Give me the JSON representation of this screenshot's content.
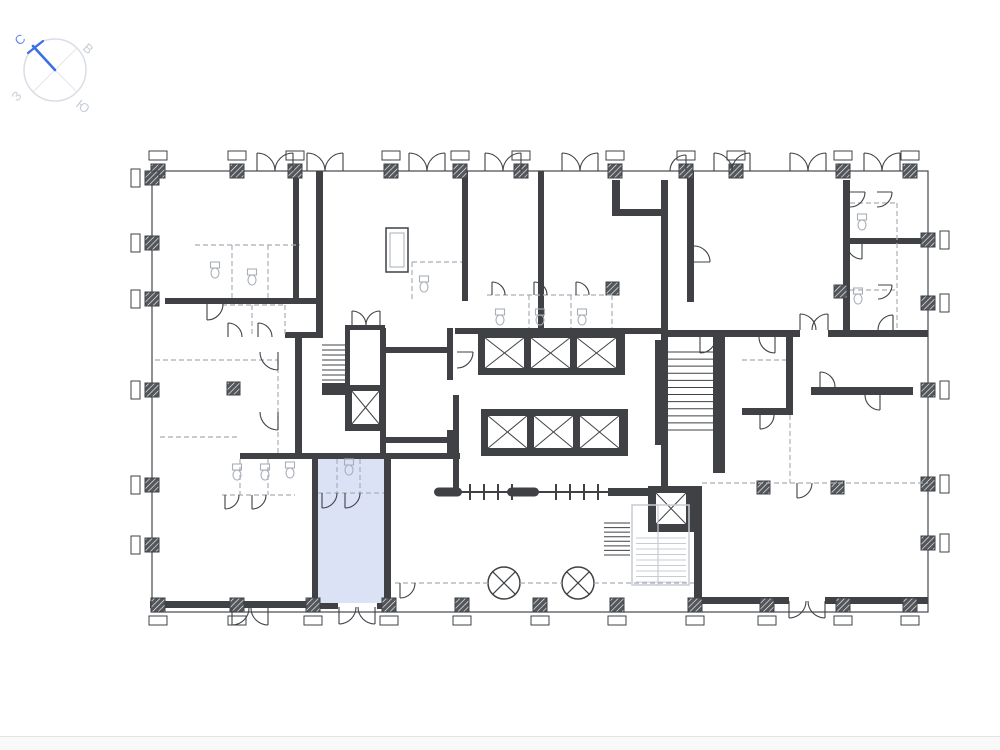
{
  "page": {
    "background": "#ffffff",
    "footer_line_color": "#e3e3e6",
    "footer_band_color": "#f9f9fa"
  },
  "compass": {
    "labels": {
      "north": "С",
      "east": "В",
      "west": "З",
      "south": "Ю"
    },
    "colors": {
      "needle": "#3a6fe8",
      "north_label": "#6188ec",
      "other_labels": "#c8cdd7",
      "ring": "#d9dee6",
      "cross": "#e4e7ec"
    }
  },
  "plan": {
    "colors": {
      "wall": "#3f4145",
      "line": "#46484c",
      "light": "#a9afb8",
      "stair": "#c7ccd4",
      "highlight": "#dbe2f6",
      "white": "#ffffff"
    },
    "highlight_room": {
      "x": 318,
      "y": 459,
      "w": 66,
      "h": 144
    },
    "primitives": [
      [
        "r",
        318,
        459,
        66,
        144,
        "highlight"
      ],
      [
        "ro",
        152,
        171,
        776,
        441,
        "line",
        1.2
      ],
      [
        "r",
        293,
        171,
        6,
        130,
        "wall"
      ],
      [
        "r",
        316,
        171,
        7,
        163,
        "wall"
      ],
      [
        "r",
        165,
        298,
        157,
        6,
        "wall"
      ],
      [
        "r",
        295,
        334,
        7,
        123,
        "wall"
      ],
      [
        "r",
        285,
        332,
        38,
        6,
        "wall"
      ],
      [
        "r",
        240,
        453,
        220,
        6,
        "wall"
      ],
      [
        "r",
        312,
        459,
        6,
        148,
        "wall"
      ],
      [
        "r",
        384,
        453,
        7,
        154,
        "wall"
      ],
      [
        "r",
        150,
        601,
        163,
        7,
        "wall"
      ],
      [
        "r",
        313,
        603,
        25,
        6,
        "wall"
      ],
      [
        "r",
        377,
        603,
        14,
        6,
        "wall"
      ],
      [
        "r",
        462,
        171,
        6,
        130,
        "wall"
      ],
      [
        "r",
        538,
        171,
        6,
        160,
        "wall"
      ],
      [
        "r",
        612,
        180,
        8,
        36,
        "wall"
      ],
      [
        "r",
        612,
        209,
        56,
        7,
        "wall"
      ],
      [
        "r",
        661,
        180,
        7,
        310,
        "wall"
      ],
      [
        "r",
        455,
        328,
        208,
        6,
        "wall"
      ],
      [
        "r",
        687,
        171,
        7,
        131,
        "wall"
      ],
      [
        "r",
        843,
        180,
        7,
        156,
        "wall"
      ],
      [
        "r",
        850,
        238,
        78,
        6,
        "wall"
      ],
      [
        "r",
        663,
        330,
        137,
        7,
        "wall"
      ],
      [
        "r",
        828,
        330,
        100,
        7,
        "wall"
      ],
      [
        "r",
        786,
        337,
        7,
        78,
        "wall"
      ],
      [
        "r",
        742,
        408,
        51,
        7,
        "wall"
      ],
      [
        "r",
        811,
        387,
        102,
        8,
        "wall"
      ],
      [
        "r",
        380,
        328,
        6,
        129,
        "wall"
      ],
      [
        "r",
        386,
        347,
        66,
        6,
        "wall"
      ],
      [
        "r",
        447,
        328,
        6,
        52,
        "wall"
      ],
      [
        "r",
        447,
        430,
        6,
        27,
        "wall"
      ],
      [
        "r",
        386,
        437,
        61,
        6,
        "wall"
      ],
      [
        "r",
        453,
        395,
        6,
        100,
        "wall"
      ],
      [
        "r",
        608,
        488,
        45,
        8,
        "wall"
      ],
      [
        "r",
        694,
        486,
        8,
        116,
        "wall"
      ],
      [
        "r",
        655,
        340,
        6,
        105,
        "wall"
      ],
      [
        "r",
        713,
        337,
        12,
        136,
        "wall"
      ],
      [
        "r",
        695,
        597,
        94,
        7,
        "wall"
      ],
      [
        "r",
        825,
        597,
        103,
        7,
        "wall"
      ],
      [
        "r",
        322,
        383,
        24,
        12,
        "wall"
      ],
      [
        "r",
        478,
        331,
        147,
        44,
        "wall"
      ],
      [
        "e",
        484,
        337,
        41,
        32
      ],
      [
        "e",
        530,
        337,
        41,
        32
      ],
      [
        "e",
        576,
        337,
        41,
        32
      ],
      [
        "r",
        481,
        409,
        147,
        47,
        "wall"
      ],
      [
        "e",
        487,
        415,
        41,
        34
      ],
      [
        "e",
        533,
        415,
        41,
        34
      ],
      [
        "e",
        579,
        415,
        41,
        34
      ],
      [
        "r",
        345,
        325,
        40,
        106,
        "wall"
      ],
      [
        "r",
        350,
        330,
        30,
        55,
        "white"
      ],
      [
        "e",
        351,
        390,
        29,
        35
      ],
      [
        "r",
        648,
        486,
        46,
        46,
        "wall"
      ],
      [
        "e",
        655,
        492,
        32,
        33
      ],
      [
        "ro",
        386,
        228,
        22,
        44,
        "wall",
        1.5
      ],
      [
        "ro",
        390,
        233,
        14,
        34,
        "light",
        1
      ],
      [
        "st",
        322,
        345,
        25,
        40,
        8,
        "wall"
      ],
      [
        "st",
        668,
        352,
        45,
        78,
        11,
        "wall"
      ],
      [
        "st",
        604,
        523,
        26,
        32,
        7,
        "wall"
      ],
      [
        "ro",
        632,
        505,
        57,
        80,
        "stair",
        1.5
      ],
      [
        "st",
        636,
        538,
        50,
        44,
        8,
        "stair"
      ],
      [
        "l",
        658,
        505,
        658,
        585,
        "stair",
        1.2
      ],
      [
        "cx",
        504,
        583,
        16
      ],
      [
        "cx",
        578,
        583,
        16
      ],
      [
        "l",
        457,
        492,
        648,
        492,
        "wall",
        2
      ],
      [
        "l",
        470,
        484,
        470,
        500,
        "wall",
        2
      ],
      [
        "l",
        484,
        484,
        484,
        500,
        "wall",
        2
      ],
      [
        "l",
        498,
        484,
        498,
        500,
        "wall",
        2
      ],
      [
        "l",
        512,
        484,
        512,
        500,
        "wall",
        2
      ],
      [
        "l",
        556,
        484,
        556,
        500,
        "wall",
        2
      ],
      [
        "l",
        570,
        484,
        570,
        500,
        "wall",
        2
      ],
      [
        "l",
        584,
        484,
        584,
        500,
        "wall",
        2
      ],
      [
        "l",
        598,
        484,
        598,
        500,
        "wall",
        2
      ],
      [
        "p",
        448,
        492,
        28,
        9
      ],
      [
        "p",
        523,
        492,
        32,
        9
      ],
      [
        "col",
        158,
        171,
        "t"
      ],
      [
        "col",
        237,
        171,
        "t"
      ],
      [
        "col",
        295,
        171,
        "t"
      ],
      [
        "col",
        391,
        171,
        "t"
      ],
      [
        "col",
        460,
        171,
        "t"
      ],
      [
        "col",
        521,
        171,
        "t"
      ],
      [
        "col",
        615,
        171,
        "t"
      ],
      [
        "col",
        686,
        171,
        "t"
      ],
      [
        "col",
        736,
        171,
        "t"
      ],
      [
        "col",
        843,
        171,
        "t"
      ],
      [
        "col",
        910,
        171,
        "t"
      ],
      [
        "col",
        152,
        178,
        "l"
      ],
      [
        "col",
        152,
        243,
        "l"
      ],
      [
        "col",
        152,
        299,
        "l"
      ],
      [
        "col",
        152,
        390,
        "l"
      ],
      [
        "col",
        152,
        485,
        "l"
      ],
      [
        "col",
        152,
        545,
        "l"
      ],
      [
        "col",
        928,
        240,
        "r"
      ],
      [
        "col",
        928,
        303,
        "r"
      ],
      [
        "col",
        928,
        390,
        "r"
      ],
      [
        "col",
        928,
        484,
        "r"
      ],
      [
        "col",
        928,
        543,
        "r"
      ],
      [
        "col",
        158,
        605,
        "b"
      ],
      [
        "col",
        237,
        605,
        "b"
      ],
      [
        "col",
        313,
        605,
        "b"
      ],
      [
        "col",
        389,
        605,
        "b"
      ],
      [
        "col",
        462,
        605,
        "b"
      ],
      [
        "col",
        540,
        605,
        "b"
      ],
      [
        "col",
        617,
        605,
        "b"
      ],
      [
        "col",
        695,
        605,
        "b"
      ],
      [
        "col",
        767,
        605,
        "b"
      ],
      [
        "col",
        843,
        605,
        "b"
      ],
      [
        "col",
        910,
        605,
        "b"
      ],
      [
        "ic",
        233,
        388
      ],
      [
        "ic",
        612,
        288
      ],
      [
        "ic",
        763,
        487
      ],
      [
        "ic",
        837,
        487
      ],
      [
        "ic",
        840,
        291
      ],
      [
        "d",
        195,
        245,
        300,
        245
      ],
      [
        "d",
        232,
        245,
        232,
        298
      ],
      [
        "d",
        268,
        245,
        268,
        298
      ],
      [
        "d",
        222,
        305,
        285,
        305
      ],
      [
        "d",
        285,
        305,
        285,
        337
      ],
      [
        "d",
        252,
        305,
        252,
        337
      ],
      [
        "d",
        155,
        360,
        278,
        360
      ],
      [
        "d",
        278,
        360,
        278,
        455
      ],
      [
        "d",
        160,
        437,
        240,
        437
      ],
      [
        "d",
        487,
        295,
        612,
        295
      ],
      [
        "d",
        529,
        295,
        529,
        328
      ],
      [
        "d",
        571,
        295,
        571,
        328
      ],
      [
        "d",
        612,
        295,
        612,
        328
      ],
      [
        "d",
        412,
        262,
        462,
        262
      ],
      [
        "d",
        412,
        262,
        412,
        301
      ],
      [
        "d",
        318,
        493,
        384,
        493
      ],
      [
        "d",
        337,
        459,
        337,
        493
      ],
      [
        "d",
        360,
        459,
        360,
        493
      ],
      [
        "d",
        222,
        495,
        295,
        495
      ],
      [
        "d",
        240,
        459,
        240,
        495
      ],
      [
        "d",
        268,
        459,
        268,
        495
      ],
      [
        "d",
        897,
        203,
        897,
        330
      ],
      [
        "d",
        850,
        290,
        897,
        290
      ],
      [
        "d",
        850,
        203,
        897,
        203
      ],
      [
        "d",
        790,
        415,
        790,
        483
      ],
      [
        "d",
        742,
        360,
        786,
        360
      ],
      [
        "d",
        702,
        483,
        928,
        483
      ],
      [
        "d",
        395,
        583,
        488,
        583
      ],
      [
        "d",
        520,
        583,
        562,
        583
      ],
      [
        "d",
        594,
        583,
        694,
        583
      ],
      [
        "a",
        257,
        171,
        18,
        270,
        0,
        1
      ],
      [
        "a",
        293,
        171,
        18,
        270,
        180,
        0
      ],
      [
        "a",
        307,
        171,
        18,
        270,
        0,
        1
      ],
      [
        "a",
        343,
        171,
        18,
        270,
        180,
        0
      ],
      [
        "a",
        409,
        171,
        18,
        270,
        0,
        1
      ],
      [
        "a",
        445,
        171,
        18,
        270,
        180,
        0
      ],
      [
        "a",
        485,
        171,
        18,
        270,
        0,
        1
      ],
      [
        "a",
        521,
        171,
        18,
        270,
        180,
        0
      ],
      [
        "a",
        562,
        171,
        18,
        270,
        0,
        1
      ],
      [
        "a",
        598,
        171,
        18,
        270,
        180,
        0
      ],
      [
        "a",
        714,
        171,
        18,
        270,
        0,
        1
      ],
      [
        "a",
        750,
        171,
        18,
        270,
        180,
        0
      ],
      [
        "a",
        790,
        171,
        18,
        270,
        0,
        1
      ],
      [
        "a",
        826,
        171,
        18,
        270,
        180,
        0
      ],
      [
        "a",
        864,
        171,
        18,
        270,
        0,
        1
      ],
      [
        "a",
        900,
        171,
        18,
        270,
        180,
        0
      ],
      [
        "a",
        686,
        171,
        16,
        270,
        180,
        0
      ],
      [
        "a",
        339,
        607,
        17,
        90,
        0,
        0
      ],
      [
        "a",
        375,
        607,
        17,
        90,
        180,
        1
      ],
      [
        "a",
        232,
        608,
        17,
        90,
        0,
        0
      ],
      [
        "a",
        268,
        608,
        17,
        90,
        180,
        1
      ],
      [
        "a",
        789,
        601,
        17,
        90,
        0,
        0
      ],
      [
        "a",
        825,
        601,
        17,
        90,
        180,
        1
      ],
      [
        "a",
        400,
        583,
        15,
        90,
        0,
        0
      ],
      [
        "a",
        492,
        295,
        13,
        270,
        0,
        1
      ],
      [
        "a",
        534,
        295,
        13,
        270,
        0,
        1
      ],
      [
        "a",
        576,
        295,
        13,
        270,
        0,
        1
      ],
      [
        "a",
        207,
        304,
        16,
        90,
        0,
        0
      ],
      [
        "a",
        228,
        337,
        14,
        270,
        0,
        1
      ],
      [
        "a",
        258,
        337,
        14,
        270,
        0,
        1
      ],
      [
        "a",
        278,
        352,
        18,
        90,
        180,
        1
      ],
      [
        "a",
        278,
        412,
        18,
        90,
        180,
        1
      ],
      [
        "a",
        322,
        493,
        15,
        90,
        0,
        0
      ],
      [
        "a",
        345,
        493,
        15,
        90,
        0,
        0
      ],
      [
        "a",
        225,
        495,
        14,
        90,
        0,
        0
      ],
      [
        "a",
        252,
        495,
        14,
        90,
        0,
        0
      ],
      [
        "a",
        352,
        325,
        14,
        270,
        0,
        1
      ],
      [
        "a",
        380,
        325,
        14,
        270,
        180,
        0
      ],
      [
        "a",
        457,
        352,
        16,
        0,
        90,
        1
      ],
      [
        "a",
        694,
        262,
        16,
        0,
        270,
        0
      ],
      [
        "a",
        862,
        244,
        15,
        90,
        180,
        1
      ],
      [
        "a",
        893,
        330,
        15,
        270,
        180,
        0
      ],
      [
        "a",
        700,
        337,
        16,
        90,
        0,
        0
      ],
      [
        "a",
        775,
        337,
        16,
        90,
        180,
        1
      ],
      [
        "a",
        800,
        330,
        16,
        270,
        0,
        1
      ],
      [
        "a",
        828,
        330,
        16,
        270,
        180,
        0
      ],
      [
        "a",
        820,
        387,
        15,
        270,
        0,
        1
      ],
      [
        "a",
        880,
        395,
        15,
        90,
        180,
        1
      ],
      [
        "a",
        760,
        415,
        14,
        90,
        0,
        0
      ],
      [
        "a",
        797,
        483,
        15,
        90,
        0,
        0
      ],
      [
        "a",
        850,
        192,
        15,
        0,
        90,
        1
      ],
      [
        "a",
        877,
        192,
        15,
        0,
        90,
        1
      ],
      [
        "a",
        878,
        285,
        14,
        0,
        90,
        1
      ],
      [
        "wc",
        215,
        270
      ],
      [
        "wc",
        252,
        277
      ],
      [
        "wc",
        424,
        284
      ],
      [
        "wc",
        500,
        317
      ],
      [
        "wc",
        540,
        317
      ],
      [
        "wc",
        582,
        317
      ],
      [
        "wc",
        349,
        467
      ],
      [
        "wc",
        290,
        470
      ],
      [
        "wc",
        237,
        472
      ],
      [
        "wc",
        265,
        472
      ],
      [
        "wc",
        862,
        222
      ],
      [
        "wc",
        858,
        296
      ]
    ]
  }
}
